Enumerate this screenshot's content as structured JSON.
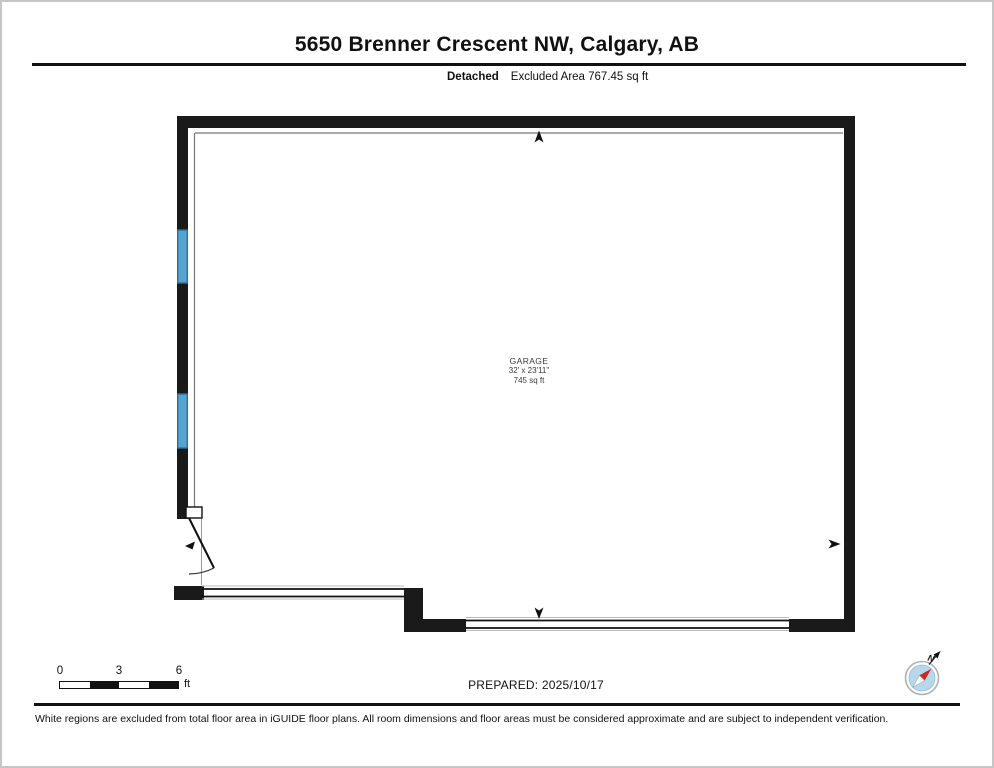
{
  "page": {
    "title": "5650 Brenner Crescent NW, Calgary, AB",
    "property_type": "Detached",
    "excluded_area": "Excluded Area 767.45 sq ft"
  },
  "floor_plan": {
    "room_label": {
      "name": "GARAGE",
      "dimensions": "32' x 23'11\"",
      "area": "745 sq ft"
    },
    "colors": {
      "wall": "#1a1a1a",
      "window": "#55a5d2",
      "window_edge": "#2e6f96"
    }
  },
  "scale_bar": {
    "ticks": [
      "0",
      "3",
      "6"
    ],
    "unit": "ft"
  },
  "prepared": {
    "label": "PREPARED: 2025/10/17"
  },
  "compass": {
    "north_label": "N",
    "needle_color": "#cc2a1e",
    "face_color": "#b7d8ea"
  },
  "disclaimer": "White regions are excluded from total floor area in iGUIDE floor plans. All room dimensions and floor areas must be considered approximate and are subject to independent verification."
}
